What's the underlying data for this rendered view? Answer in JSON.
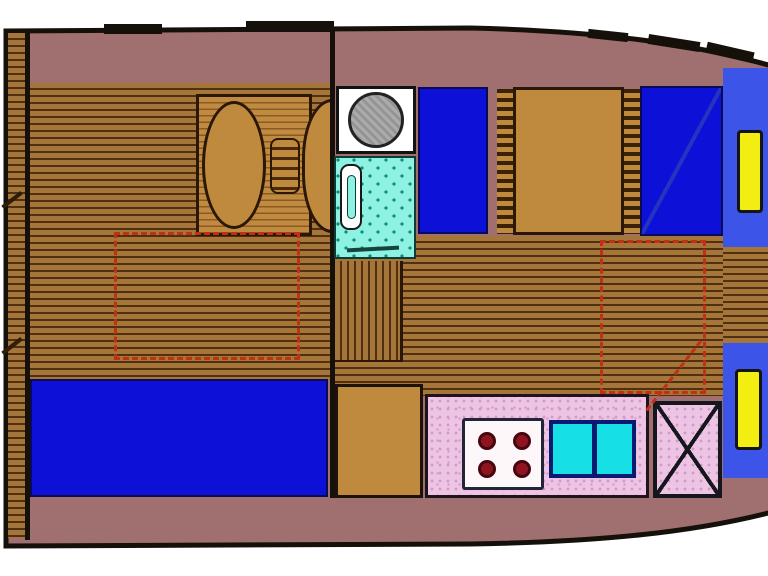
{
  "diagram": {
    "type": "boat-interior-floorplan",
    "orientation": "bow-right",
    "rooms": [
      "stern-deck",
      "saloon",
      "bathroom",
      "sleeping-cabin",
      "galley",
      "bow-cabin"
    ],
    "berth_count": 4,
    "stove_burner_count": 4,
    "sink_bowl_count": 2,
    "deck_hatch_count": 2,
    "dashed_roof_opening_count": 2
  },
  "legend": {
    "hull": "boat hull",
    "stern_deck": "stern deck planking",
    "saloon_floor": "saloon wood floor",
    "saloon_table": "saloon dinette table",
    "table_pedestal": "table pedestal / folding leaf",
    "saloon_sofa": "saloon sofa berth",
    "roof_hatch_left": "roof opening outline",
    "roof_hatch_right": "roof opening outline",
    "washbasin": "washbasin",
    "shower": "shower tray",
    "toilet": "toilet",
    "berth_port": "single berth port side",
    "berth_starboard": "single berth starboard side",
    "berth_chest": "cabinet between berths",
    "ladder": "ladder rungs",
    "companionway_steps": "companionway steps",
    "corridor": "corridor planking",
    "galley_counter": "galley worktop",
    "galley_cupboard": "galley cupboard",
    "stove": "four burner stove",
    "sink": "double sink",
    "icebox": "crossed icebox unit",
    "bow_seat": "bow berth cushion",
    "deck_hatch": "deck hatch"
  },
  "colors": {
    "background": "#ffffff",
    "hull": "#a07070",
    "outline": "#151009",
    "plank": "#a5753a",
    "plank_line": "#4f3010",
    "panel_plank": "#c18a42",
    "panel_plank_line": "#8a5a1e",
    "wood_solid": "#c08a3e",
    "berth_blue": "#0d11d8",
    "bow_blue": "#3c55e8",
    "hatch_yellow": "#f2ee12",
    "shower_cyan": "#8df2e2",
    "shower_dot": "#0e8e74",
    "sink_cyan": "#16dfe6",
    "sink_border": "#0a1a70",
    "galley_pink": "#eec4e4",
    "galley_speckle": "#cf9cc6",
    "stove_white": "#fdf7f9",
    "burner_red": "#8e1420",
    "burner_dark": "#47060e",
    "basin_gray": "#ababab",
    "red_dash": "#c23014",
    "diagonal_navy": "#2433c0"
  }
}
